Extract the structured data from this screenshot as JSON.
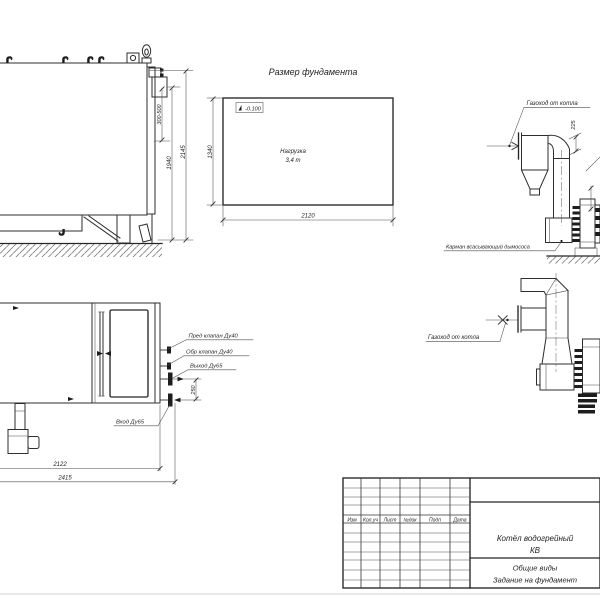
{
  "drawing": {
    "foundation": {
      "title": "Размер фундамента",
      "elevation_mark": "-0.100",
      "load_line1": "Нагрузка",
      "load_line2": "3,4 т",
      "dim_width": "2120",
      "dim_depth": "1340"
    },
    "side_view": {
      "dim_stack_range": "300-500",
      "dim_height_flange": "1940",
      "dim_height_total": "2145"
    },
    "plan_view": {
      "label_safety_valve": "Пред клапан Ду40",
      "label_check_valve": "Обр клапан Ду40",
      "label_outlet": "Выход Ду65",
      "label_inlet": "Вход Ду65",
      "dim_nozzle_offset": "250",
      "dim_length_body": "2122",
      "dim_length_total": "2415"
    },
    "flue_top_view": {
      "label_duct": "Газоход от котла",
      "dim_offset": "225",
      "label_pocket": "Карман всасывающий дымососа"
    },
    "flue_side_view": {
      "label_duct": "Газоход от котла"
    }
  },
  "title_block": {
    "columns": [
      "Изм",
      "Кол.уч",
      "Лист",
      "№док",
      "Подп",
      "Дата"
    ],
    "doc_name_line1": "Котёл водогрейный",
    "doc_name_line2": "КВ",
    "view_name_line1": "Общие виды",
    "view_name_line2": "Задание на фундамент"
  }
}
